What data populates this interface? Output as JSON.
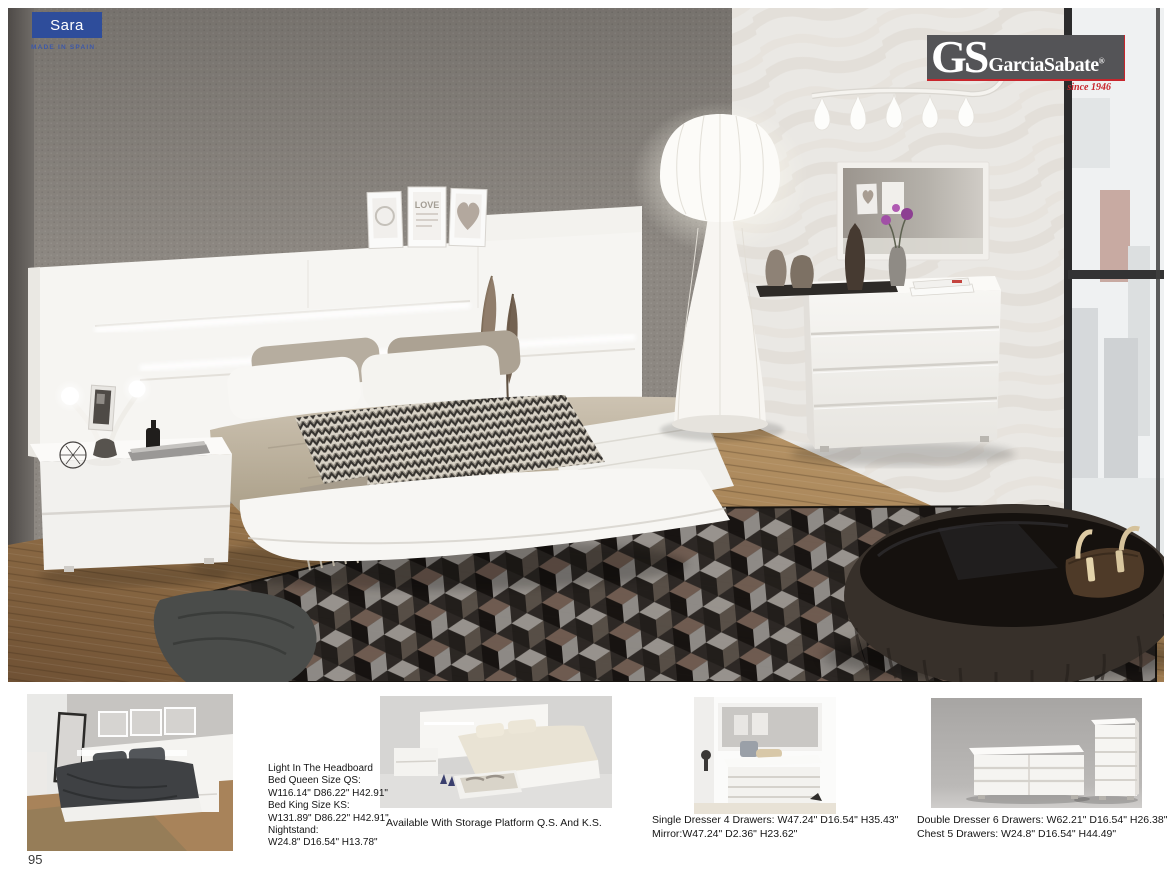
{
  "page": {
    "number": "95"
  },
  "badge": {
    "label": "Sara",
    "made_in": "MADE IN SPAIN"
  },
  "brand": {
    "initials": "GS",
    "name": "GarciaSabate",
    "registered": "®",
    "since": "since 1946"
  },
  "hero": {
    "frame_text": "LOVE"
  },
  "colors": {
    "badge_blue": "#2e4d9b",
    "brand_box_gray": "#545457",
    "brand_red": "#c8252c"
  },
  "products": [
    {
      "lines": [
        "Light In The Headboard",
        "Bed Queen Size QS:",
        "W116.14\" D86.22\" H42.91\"",
        "Bed King Size KS:",
        "W131.89\" D86.22\" H42.91\"",
        "Nightstand:",
        "W24.8\" D16.54\" H13.78\""
      ]
    },
    {
      "lines": [
        "Available With Storage Platform Q.S. And K.S."
      ]
    },
    {
      "lines": [
        "Single Dresser 4 Drawers: W47.24\" D16.54\" H35.43\"",
        "Mirror:W47.24\" D2.36\" H23.62\""
      ]
    },
    {
      "lines": [
        "Double Dresser 6 Drawers: W62.21\" D16.54\" H26.38\"",
        "Chest 5 Drawers: W24.8\" D16.54\" H44.49\""
      ]
    }
  ]
}
